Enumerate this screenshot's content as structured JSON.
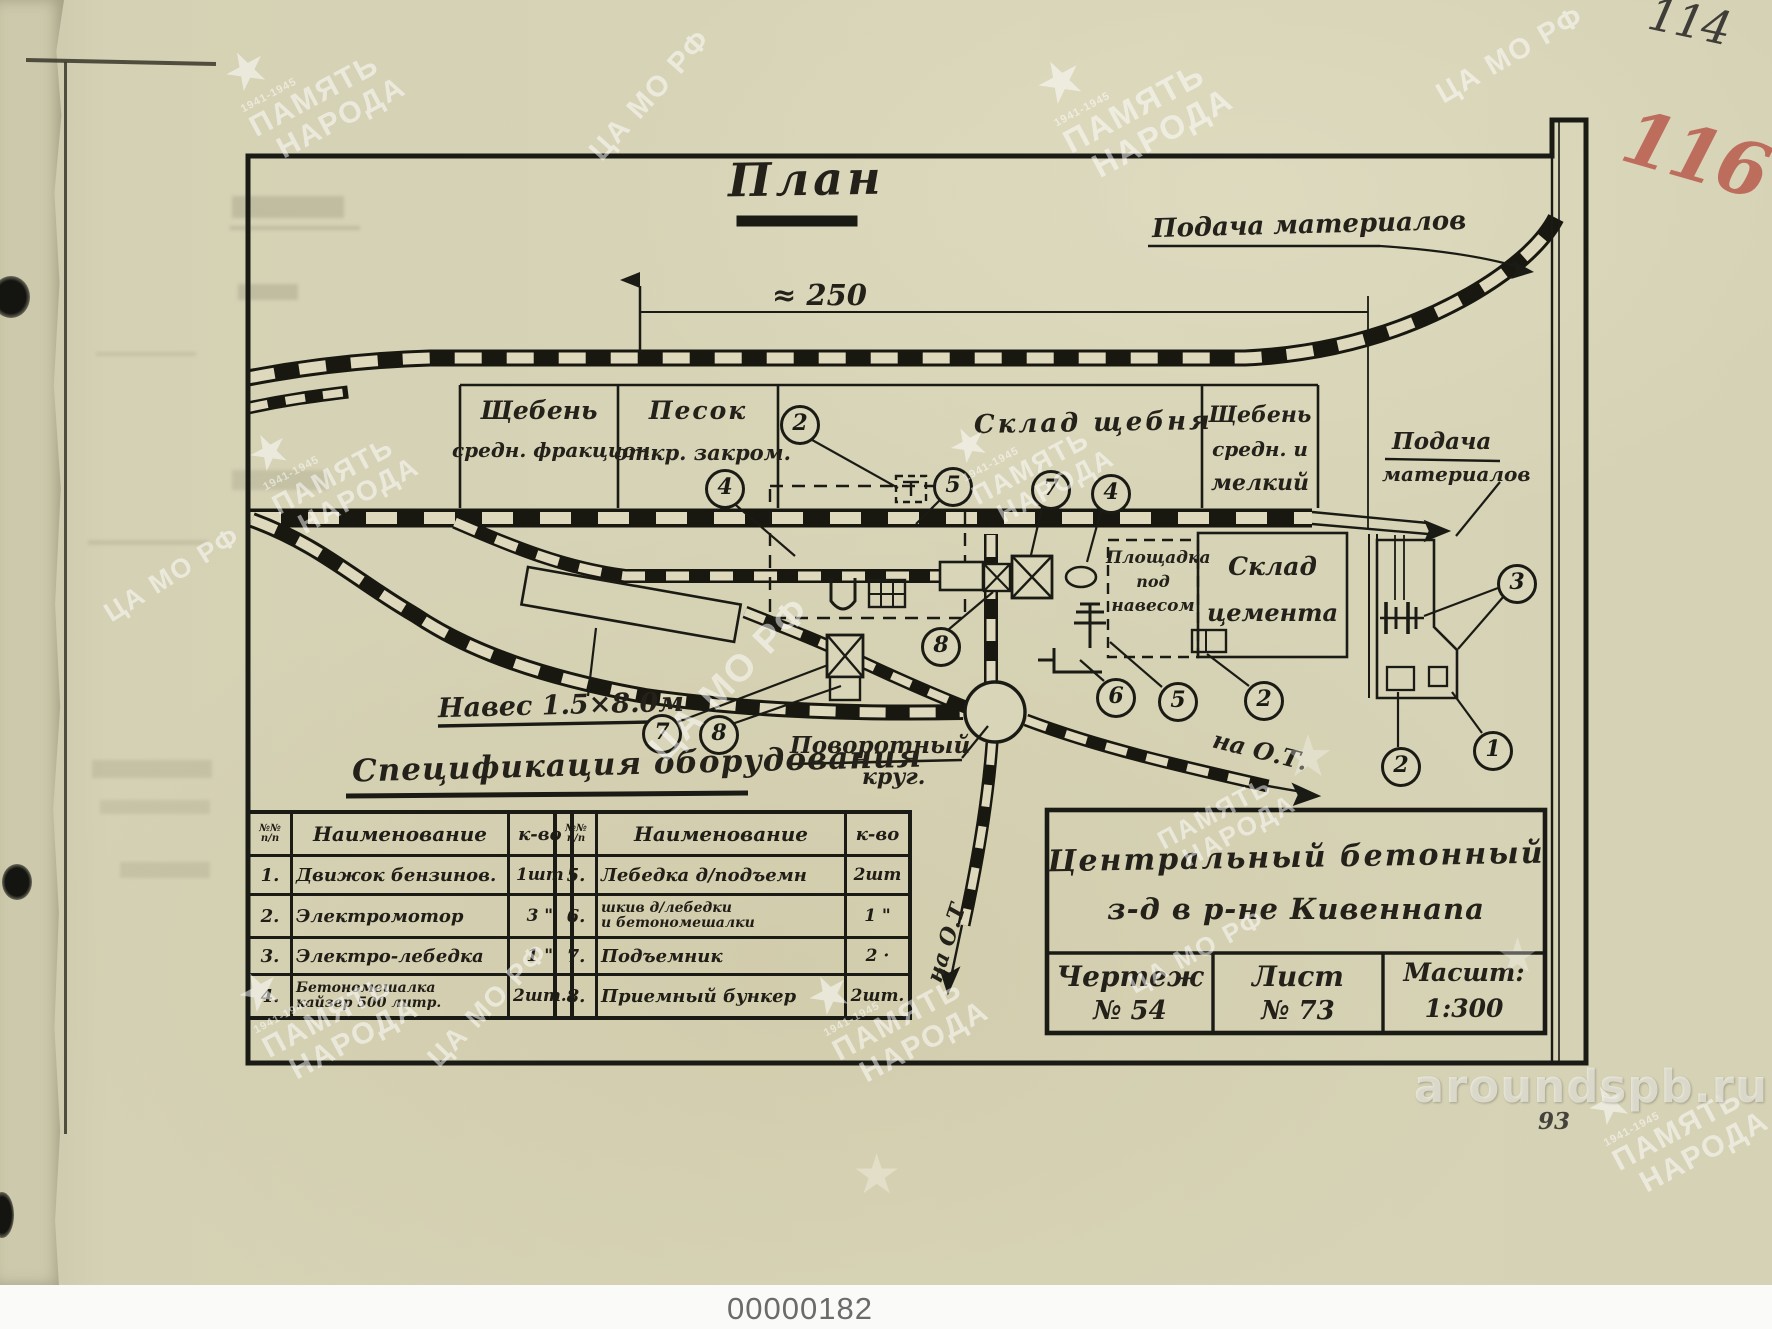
{
  "page": {
    "sheet_number_pencil": "114",
    "sheet_number_red": "116",
    "page_number": "93",
    "scan_id": "00000182",
    "site_watermark": "aroundspb.ru"
  },
  "watermarks": {
    "memory_line1": "ПАМЯТЬ",
    "memory_line2": "НАРОДА",
    "years": "1941-1945",
    "archive": "ЦА МО РФ",
    "star_glyph": "★",
    "instances": [
      {
        "kind": "star-pn",
        "x": 235,
        "y": 14,
        "rot": -28,
        "size": 30
      },
      {
        "kind": "camo",
        "x": 568,
        "y": 80,
        "rot": -48,
        "size": 29
      },
      {
        "kind": "star-pn",
        "x": 1048,
        "y": 20,
        "rot": -28,
        "size": 33
      },
      {
        "kind": "camo",
        "x": 1428,
        "y": 40,
        "rot": -30,
        "size": 29
      },
      {
        "kind": "star-pn",
        "x": 258,
        "y": 398,
        "rot": -28,
        "size": 28
      },
      {
        "kind": "camo",
        "x": 95,
        "y": 560,
        "rot": -32,
        "size": 27
      },
      {
        "kind": "camo",
        "x": 625,
        "y": 660,
        "rot": -46,
        "size": 38
      },
      {
        "kind": "star-pn",
        "x": 958,
        "y": 392,
        "rot": -28,
        "size": 27
      },
      {
        "kind": "star",
        "x": 1282,
        "y": 722,
        "rot": 0,
        "size": 58
      },
      {
        "kind": "pn",
        "x": 1158,
        "y": 795,
        "rot": -28,
        "size": 26
      },
      {
        "kind": "star-pn",
        "x": 248,
        "y": 935,
        "rot": -28,
        "size": 30
      },
      {
        "kind": "star-pn",
        "x": 818,
        "y": 938,
        "rot": -28,
        "size": 30
      },
      {
        "kind": "star-pn",
        "x": 1598,
        "y": 1048,
        "rot": -28,
        "size": 30
      },
      {
        "kind": "camo",
        "x": 408,
        "y": 990,
        "rot": -46,
        "size": 28
      },
      {
        "kind": "camo",
        "x": 1122,
        "y": 938,
        "rot": -28,
        "size": 26
      },
      {
        "kind": "star",
        "x": 1496,
        "y": 928,
        "rot": 0,
        "size": 48
      },
      {
        "kind": "star",
        "x": 852,
        "y": 1142,
        "rot": 0,
        "size": 55
      }
    ]
  },
  "drawing": {
    "title": "План",
    "dimension_label": "≈ 250",
    "feed_top": "Подача материалов",
    "feed_right_line1": "Подача",
    "feed_right_line2": "материалов",
    "areas": {
      "gravel_medium": {
        "l1": "Щебень",
        "l2": "средн. фракцион."
      },
      "sand": {
        "l1": "Песок",
        "l2": "откр. закром."
      },
      "gravel_store": "Склад щебня",
      "gravel_fine": {
        "l1": "Щебень",
        "l2": "средн. и",
        "l3": "мелкий"
      },
      "shed_area": {
        "l1": "Площадка",
        "l2": "под",
        "l3": "навесом"
      },
      "cement_store": {
        "l1": "Склад",
        "l2": "цемента"
      }
    },
    "shed_label": "Навес 1.5×8.0м",
    "turntable": {
      "l1": "Поворотный",
      "l2": "круг."
    },
    "to_ot_east": "на О.Т.",
    "to_ot_south": "на О.Т",
    "callouts": [
      {
        "n": "4",
        "x": 722,
        "y": 486
      },
      {
        "n": "2",
        "x": 797,
        "y": 422
      },
      {
        "n": "5",
        "x": 950,
        "y": 484
      },
      {
        "n": "7",
        "x": 1048,
        "y": 487
      },
      {
        "n": "4",
        "x": 1108,
        "y": 491
      },
      {
        "n": "8",
        "x": 938,
        "y": 644
      },
      {
        "n": "6",
        "x": 1113,
        "y": 695
      },
      {
        "n": "5",
        "x": 1175,
        "y": 699
      },
      {
        "n": "2",
        "x": 1261,
        "y": 698
      },
      {
        "n": "7",
        "x": 659,
        "y": 731
      },
      {
        "n": "8",
        "x": 716,
        "y": 732
      },
      {
        "n": "3",
        "x": 1514,
        "y": 581
      },
      {
        "n": "1",
        "x": 1490,
        "y": 748
      },
      {
        "n": "2",
        "x": 1398,
        "y": 764
      }
    ]
  },
  "spec_table": {
    "title": "Спецификация оборудования",
    "headers": {
      "num1": "№№",
      "num2": "п/п",
      "name": "Наименование",
      "qty": "к-во"
    },
    "left_rows": [
      {
        "num": "1.",
        "name": "Движок бензинов.",
        "name2": "",
        "qty": "1шт"
      },
      {
        "num": "2.",
        "name": "Электромотор",
        "name2": "",
        "qty": "3 \""
      },
      {
        "num": "3.",
        "name": "Электро-лебедка",
        "name2": "",
        "qty": "1 \""
      },
      {
        "num": "4.",
        "name": "Бетономешалка",
        "name2": "кайзер  500 литр.",
        "qty": "2шт."
      }
    ],
    "right_rows": [
      {
        "num": "5.",
        "name": "Лебедка д/подъемн",
        "name2": "",
        "qty": "2шт"
      },
      {
        "num": "6.",
        "name": "шкив  д/лебедки",
        "name2": "и бетономешалки",
        "qty": "1 \""
      },
      {
        "num": "7.",
        "name": "Подъемник",
        "name2": "",
        "qty": "2 ·"
      },
      {
        "num": "8.",
        "name": "Приемный бункер",
        "name2": "",
        "qty": "2шт."
      }
    ]
  },
  "title_block": {
    "line1": "Центральный  бетонный",
    "line2": "з-д  в  р-не  Кивеннапа",
    "drawing_label": "Чертеж",
    "drawing_num": "№ 54",
    "sheet_label": "Лист",
    "sheet_num": "№ 73",
    "scale_label": "Масшт:",
    "scale_value": "1:300"
  }
}
